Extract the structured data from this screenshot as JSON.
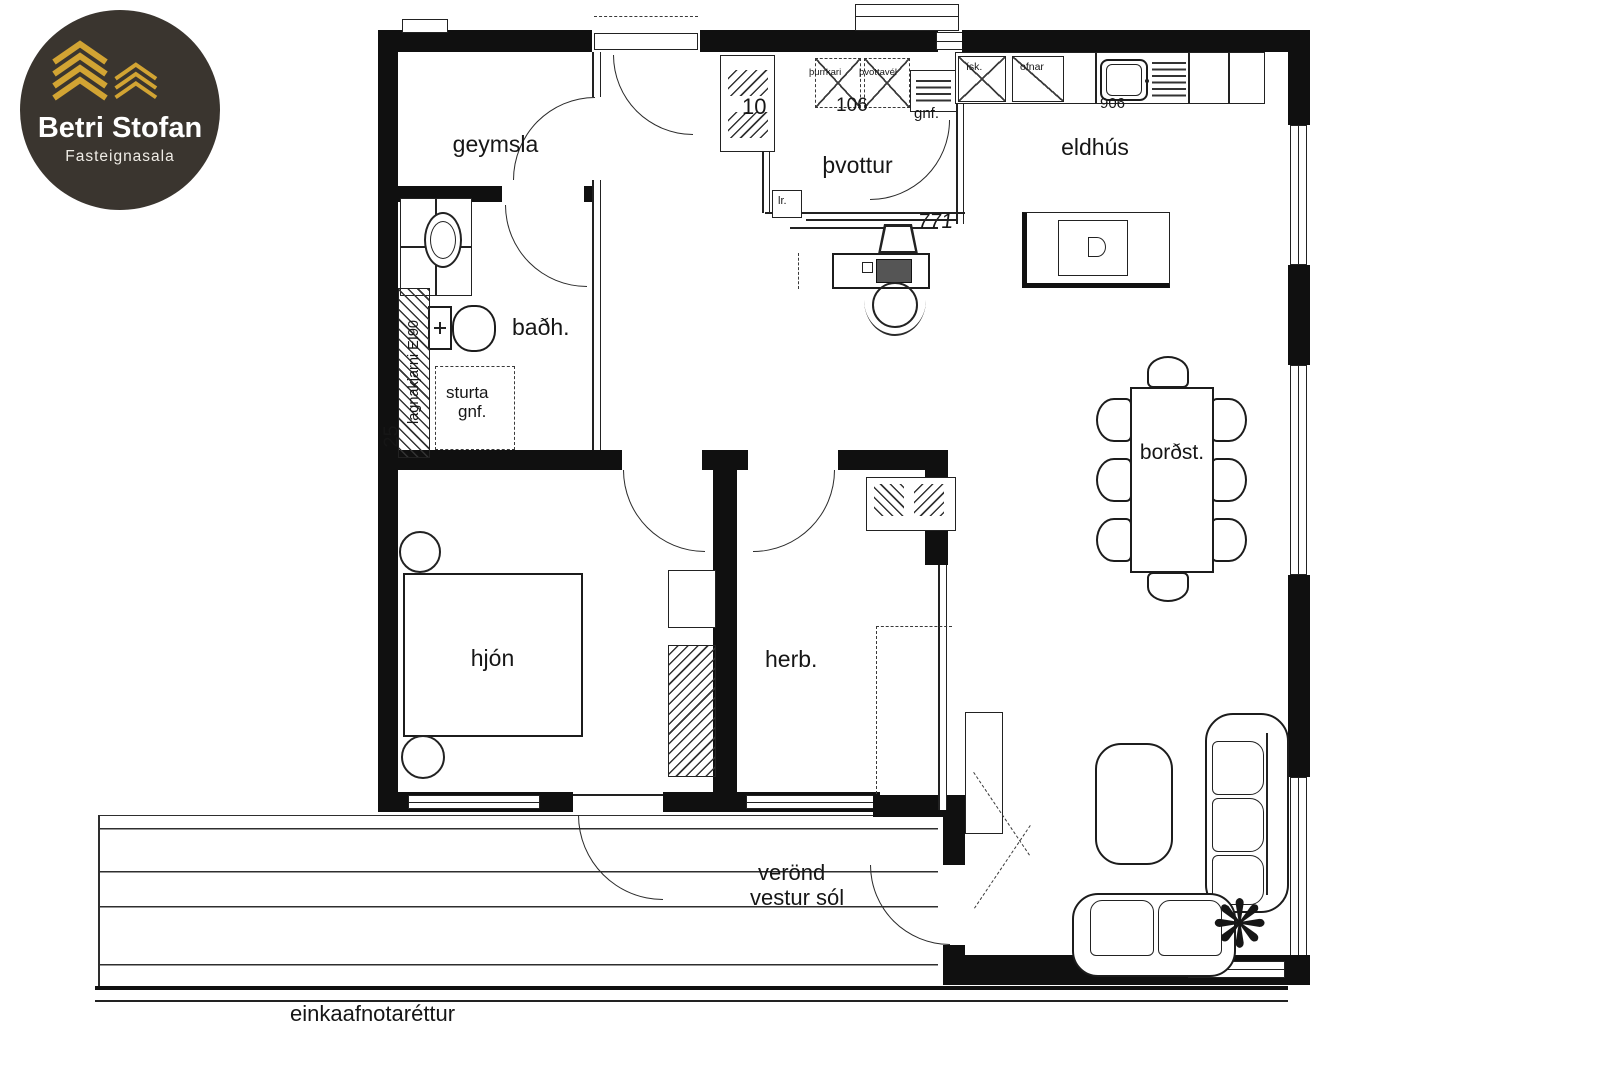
{
  "logo": {
    "brand": "Betri Stofan",
    "subtitle": "Fasteignasala",
    "colors": {
      "bg": "#3a352f",
      "gold": "#d2a433",
      "text": "#ffffff"
    }
  },
  "plan": {
    "rooms": {
      "storage": "geymsla",
      "laundry": "þvottur",
      "kitchen": "eldhús",
      "bath": "baðh.",
      "dining": "borðst.",
      "master": "hjón",
      "bedroom": "herb.",
      "veranda1": "verönd",
      "veranda2": "vestur sól",
      "easement": "einkaafnotaréttur"
    },
    "marks": {
      "shower1": "sturta",
      "shower2": "gnf.",
      "plumbing": "lagnakjarni EI90",
      "dryer": "þurrkari",
      "washer": "þvottavél",
      "fridge": "ísk.",
      "ovens": "ofnar",
      "vent": "gnf.",
      "drain": "lr.",
      "n10": "10",
      "n25": "25",
      "n106": "106",
      "n771": "771",
      "n906": "906",
      "plant_icon": "❋"
    }
  }
}
